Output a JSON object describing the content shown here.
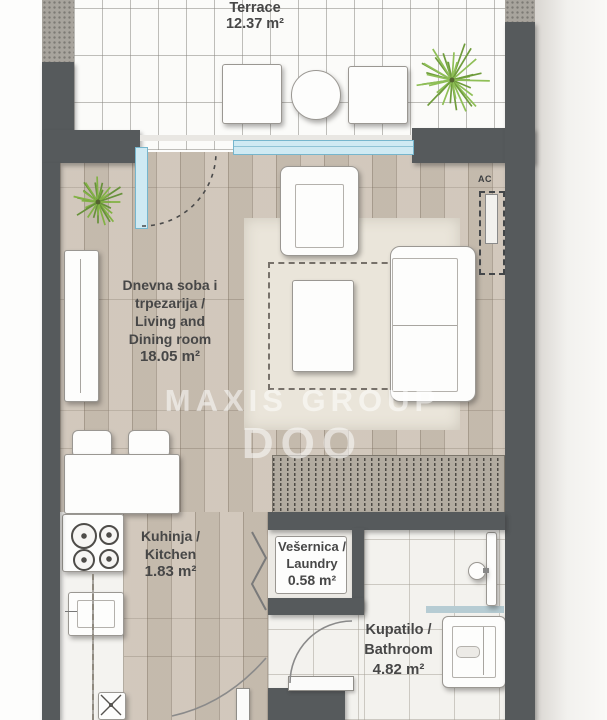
{
  "watermark": {
    "line1": "MAXIS GROUP",
    "line2": "DOO"
  },
  "rooms": {
    "terrace": {
      "lines": [
        "Terrace",
        "12.37 m²"
      ]
    },
    "living": {
      "lines": [
        "Dnevna soba i",
        "trpezarija /",
        "Living and",
        "Dining room",
        "18.05 m²"
      ]
    },
    "kitchen": {
      "lines": [
        "Kuhinja /",
        "Kitchen",
        "1.83 m²"
      ]
    },
    "laundry": {
      "lines": [
        "Vešernica /",
        "Laundry",
        "0.58 m²"
      ]
    },
    "bathroom": {
      "lines": [
        "Kupatilo /",
        "Bathroom",
        "4.82 m²"
      ]
    }
  },
  "annotations": {
    "ac": "AC"
  },
  "colors": {
    "wall": "#565a5c",
    "wood_floor": "#cdc3b6",
    "terrace_tile": "#fbfbf9",
    "bathroom_tile": "#f3f2ee",
    "glass": "#cfeaf3",
    "glass_edge": "#76b6cd",
    "plant_green": "#8fbf57",
    "hatch": "#b2aba0",
    "label_text": "#474747",
    "watermark_white": "rgba(255,255,255,0.52)"
  }
}
